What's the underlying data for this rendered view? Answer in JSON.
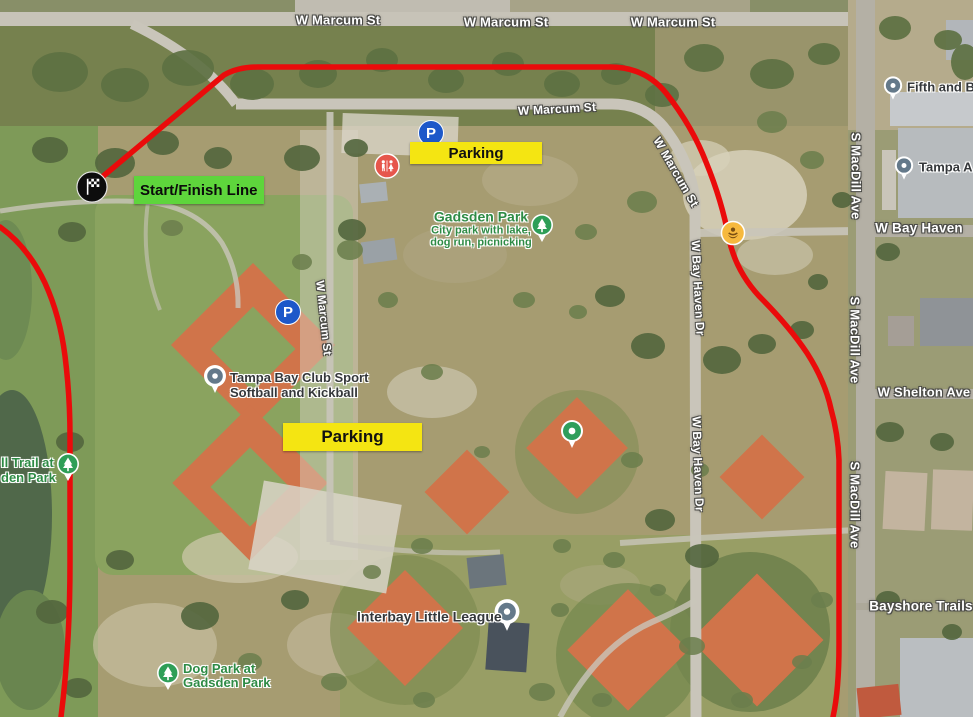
{
  "map": {
    "title": "Gadsden Park race course map",
    "colors": {
      "route_red": "#ea0b0b",
      "parking_yellow": "#f4e512",
      "start_green": "#5ed53c",
      "park_label_green": "#2e8b45",
      "parking_icon_blue": "#1d58c9",
      "restroom_icon_red": "#e6564c",
      "amber_poi": "#f6b93e",
      "pin_slate": "#64798a",
      "pin_green": "#2f9e5b",
      "flag_black": "#0d0d0d"
    }
  },
  "icons": {
    "parking_glyph": "P"
  },
  "annotations": {
    "start_finish_label": "Start/Finish Line",
    "parking_label_1": "Parking",
    "parking_label_2": "Parking"
  },
  "streets": {
    "marcum_top_1": "W Marcum St",
    "marcum_top_2": "W Marcum St",
    "marcum_top_3": "W Marcum St",
    "marcum_inner": "W Marcum St",
    "marcum_curve": "W Marcum St",
    "marcum_mid": "W Marcum St",
    "bay_haven_dr_1": "W Bay Haven Dr",
    "bay_haven_dr_2": "W Bay Haven Dr",
    "macdill_1": "S MacDill Ave",
    "macdill_2": "S MacDill Ave",
    "macdill_3": "S MacDill Ave",
    "bay_haven": "W Bay Haven",
    "shelton": "W Shelton Ave",
    "bayshore": "Bayshore Trails"
  },
  "pois": {
    "gadsden_park_title": "Gadsden Park",
    "gadsden_park_sub1": "City park with lake,",
    "gadsden_park_sub2": "dog run, picnicking",
    "club_line1": "Tampa Bay Club Sport",
    "club_line2": "Softball and Kickball",
    "interbay": "Interbay Little League",
    "dog_park_line1": "Dog Park at",
    "dog_park_line2": "Gadsden Park",
    "trail_line1": "ll Trail at",
    "trail_line2": "den Park",
    "fifth": "Fifth and B",
    "tampa": "Tampa A"
  }
}
